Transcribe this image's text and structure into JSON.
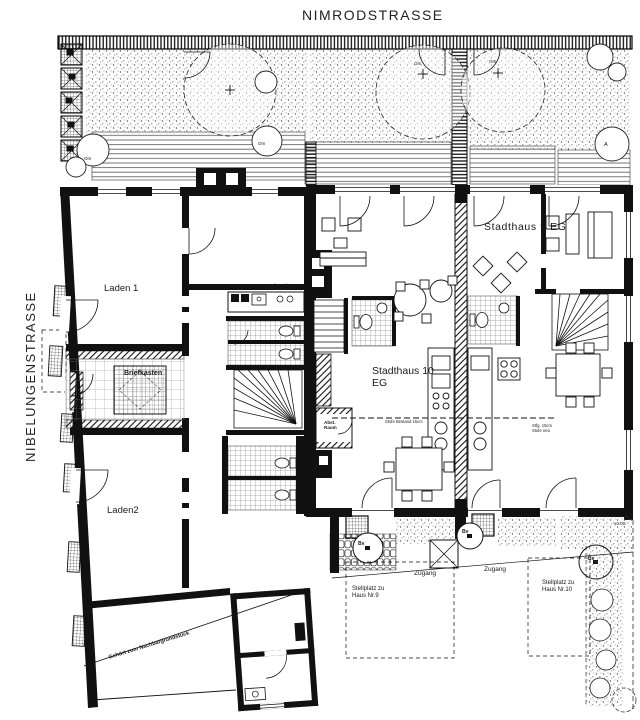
{
  "streets": {
    "top": "NIMRODSTRASSE",
    "left": "NIBELUNGENSTRASSE"
  },
  "units": {
    "laden1": "Laden 1",
    "laden2": "Laden2",
    "teekueche": "Teeküche",
    "stadthaus9": "Stadthaus 9 EG",
    "stadthaus10": "Stadthaus 10\nEG"
  },
  "rooms": {
    "briefkasten": "Briefkasten",
    "abstellraum": "Abst.\nRaum"
  },
  "outdoor": {
    "zugang": "Zugang",
    "stellplatz9": "Stellplatz zu\nHaus Nr.9",
    "stellplatz10": "Stellplatz zu\nHaus Nr.10",
    "boundary_note": "Gehört zum Nachbargrundstück"
  },
  "annotations": {
    "tree_om": "Om",
    "tree_a": "A",
    "tree_bv": "Bv",
    "level": "±0.00",
    "stufe_bestand": "Stufe Bestand 15cm",
    "stufe_detail": "Stfg. 15cm\nStufe neu"
  },
  "colors": {
    "ink": "#1a1a1a",
    "paper": "#ffffff"
  }
}
